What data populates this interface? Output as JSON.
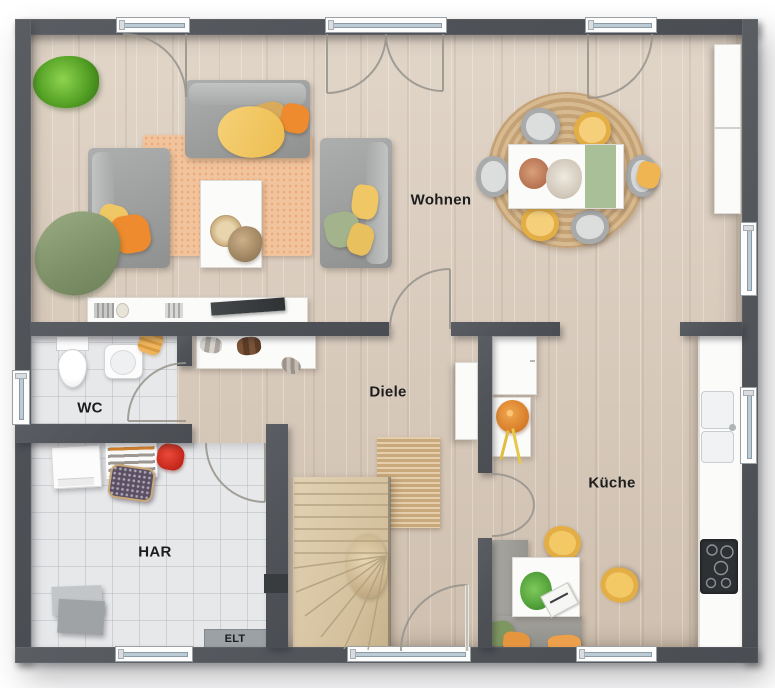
{
  "plan": {
    "title": "Erdgeschoss Grundriss",
    "rooms": {
      "wohnen": {
        "label": "Wohnen"
      },
      "diele": {
        "label": "Diele"
      },
      "kueche": {
        "label": "Küche"
      },
      "wc": {
        "label": "WC"
      },
      "har": {
        "label": "HAR"
      },
      "elt": {
        "label": "ELT"
      }
    },
    "colors": {
      "wall": "#51555a",
      "wood_floor": "#d7c9ba",
      "tile_floor": "#e7e8ea",
      "rug_living": "#f2c49d",
      "rug_jute": "#cfae7f",
      "sofa_gray": "#a3a4a4",
      "accent_orange": "#ee8b2e",
      "accent_yellow": "#f2c763",
      "accent_green": "#8ea578",
      "stairs_wood": "#dbc9aa",
      "counter_white": "#fbfbfb",
      "cooktop_black": "#2e3134",
      "plant_green": "#6cbf3e",
      "background": "#ffffff"
    }
  }
}
